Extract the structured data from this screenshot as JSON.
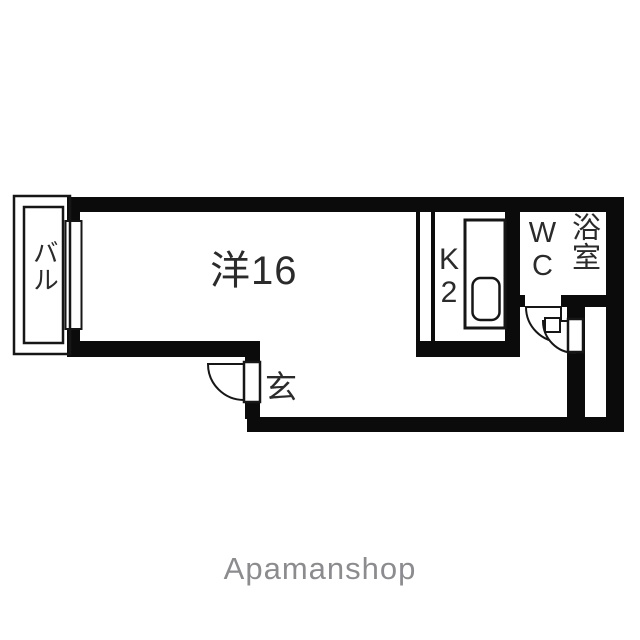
{
  "floorplan": {
    "labels": {
      "balcony": "バル",
      "living": "洋16",
      "entrance": "玄",
      "kitchen": "K2",
      "wc": "WC",
      "bath": "浴室"
    }
  },
  "footer": {
    "brand": "Apamanshop"
  },
  "colors": {
    "wall": "#0b0b0b",
    "label_text": "#2b2b2b",
    "brand_text": "#8c8c90",
    "background": "#ffffff",
    "fixture_stroke": "#161616"
  }
}
